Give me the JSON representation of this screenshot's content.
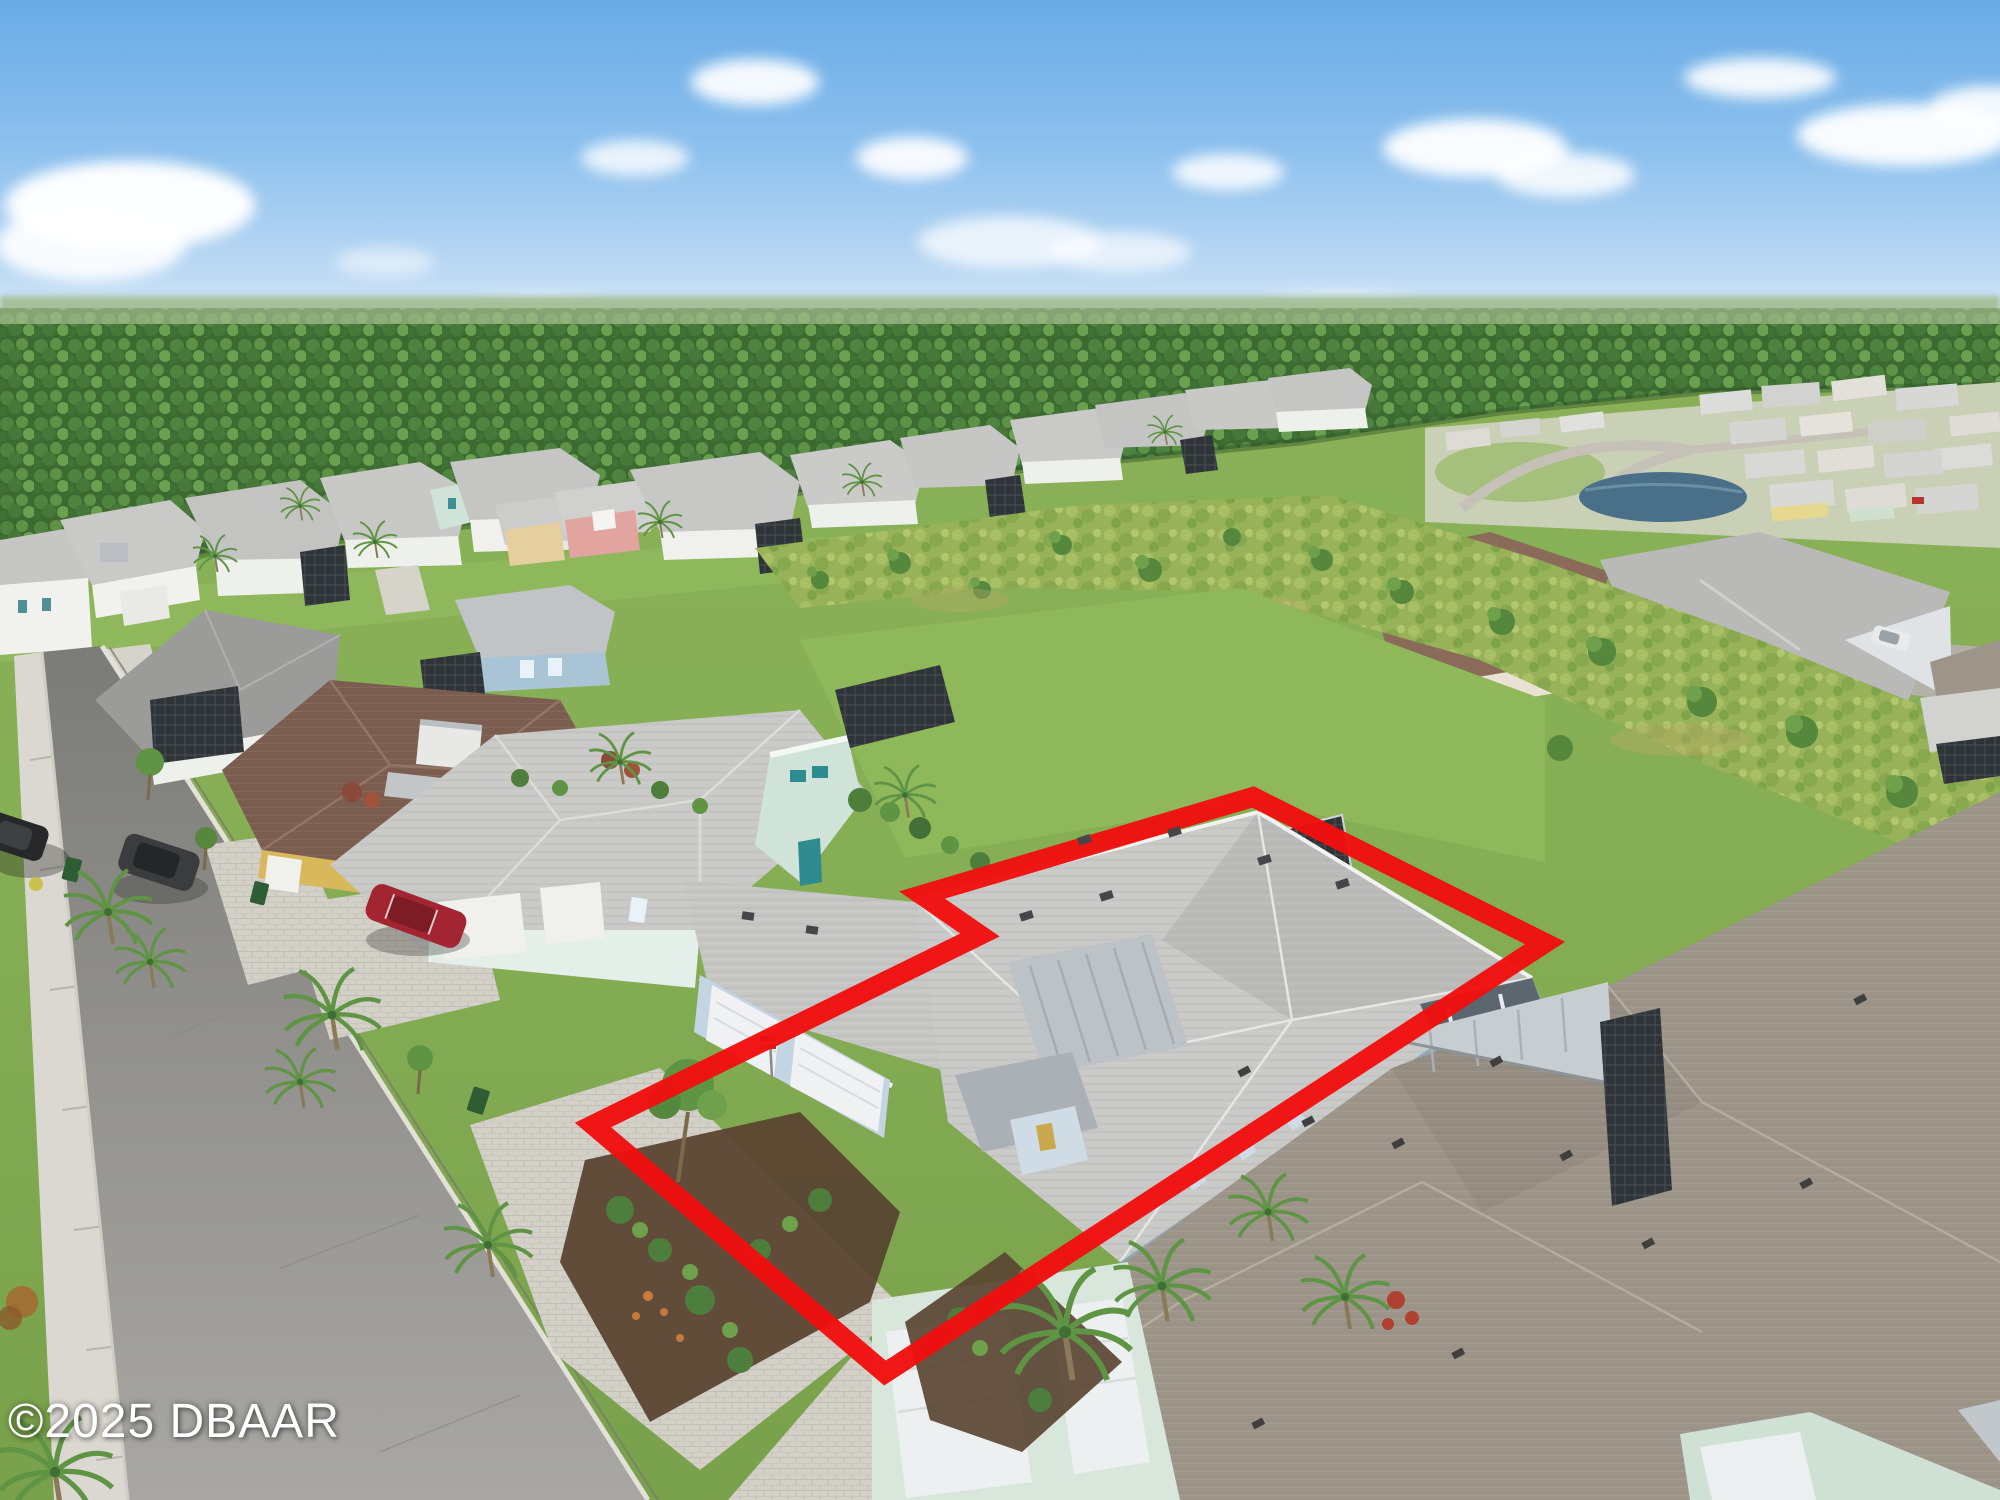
{
  "scene": {
    "type": "aerial-drone-photo",
    "description": "Aerial view of a coastal-style single-family home outlined in red within a Florida residential community, pine forest on horizon under blue sky with scattered clouds",
    "watermark": {
      "text": "©2025 DBAAR"
    }
  },
  "outline": {
    "points": "1253,797 1545,943 885,1373 593,1125 980,935 922,895",
    "stroke_width": "20"
  },
  "colors": {
    "outline": "#f10f0f",
    "watermark": "#ffffff",
    "sky-top": "#6fb0e8",
    "sky-horizon": "#dcecf8",
    "cloud": "#ffffff",
    "forest-dark": "#3c6a31",
    "forest-mid": "#4f8340",
    "scrub-green": "#97b258",
    "lawn-green": "#85ad52",
    "street-asphalt": "#908f8b",
    "sidewalk": "#dbd8d1",
    "paver": "#d3d0c8",
    "roof-gray": "#c8c8c6",
    "roof-brown": "#7c5e50",
    "roof-taupe": "#9e958a",
    "metal-roof": "#c2c7cb",
    "wall-white": "#f1f1ee",
    "wall-mint": "#cfe3d8",
    "wall-blue": "#8fa9bb",
    "wall-yellow": "#d9b85c",
    "wall-pink": "#e2a49e",
    "lanai-screen": "#2e3438",
    "pond-water": "#4a7089",
    "car-red": "#a32531"
  }
}
